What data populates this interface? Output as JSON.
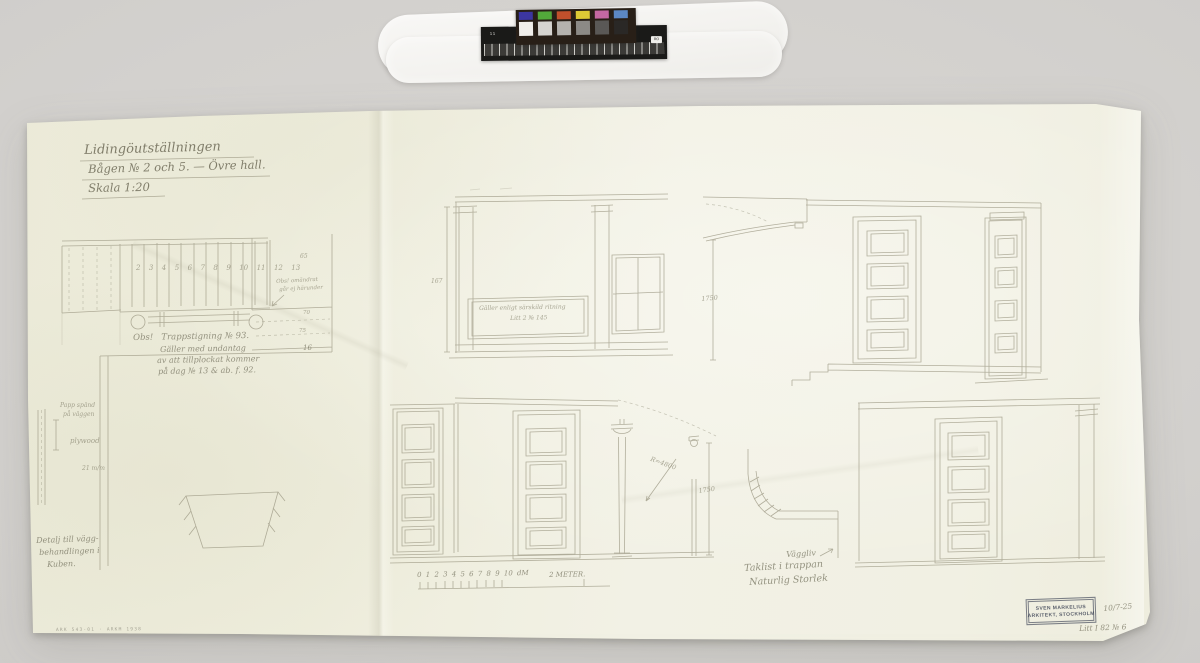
{
  "background": {
    "color": "#d5d3d0"
  },
  "calibration": {
    "ruler_left_label": "11",
    "ruler_right_label": "RO",
    "color_chips": [
      "#3c36a0",
      "#52a83a",
      "#c0502c",
      "#ddca35",
      "#c468a2",
      "#5c88c4"
    ],
    "gray_chips": [
      "#f0eeea",
      "#d6d4d0",
      "#b4b2ae",
      "#8c8a86",
      "#5a5856",
      "#2a2826"
    ]
  },
  "sheet": {
    "title": {
      "line1": "Lidingöutställningen",
      "line2": "Bågen № 2 och 5. — Övre hall.",
      "line3": "Skala 1:20"
    },
    "stair_note": {
      "line1": "Obs!   Trappstigning № 93.",
      "line2": "Gäller med undantag",
      "line3": "av att tillplockat kommer",
      "line4": "på dag № 13 & ab. f. 92."
    },
    "panel_note": {
      "line1": "Gäller enligt särskild ritning",
      "line2": "Litt 2 № 145"
    },
    "change_note": {
      "line1": "Obs! omändrat",
      "line2": "går ej härunder"
    },
    "wall_note": {
      "line1": "Papp spänd",
      "line2": "på väggen",
      "line3": "plywood",
      "line4": "21 m/m"
    },
    "detail_note": {
      "line1": "Detalj till vägg-",
      "line2": "behandlingen i",
      "line3": "Kuben."
    },
    "cove": {
      "label1": "Väggliv",
      "label2": "Taklist i trappan",
      "label3": "Naturlig Storlek"
    },
    "plan": {
      "steps": "2  3  4  5  6  7  8  9  10  11  12  13",
      "n65": "65",
      "n70": "70",
      "n75": "75",
      "n16": "16"
    },
    "dims": {
      "d167": "167",
      "d1750_top": "1750",
      "d1750_bottom": "1750",
      "radius": "R=4800"
    },
    "scale_bar": {
      "ticks": "0 1 2 3 4 5 6 7 8 9 10 dM",
      "meter": "2 METER."
    },
    "stamp": {
      "line1": "SVEN MARKELIUS",
      "line2": "ARKITEKT, STOCKHOLM"
    },
    "margin_notes": {
      "date": "10/7-25",
      "litt": "Litt I 82 № 6",
      "archive": "ARK 543-01 · ARKM 1938"
    }
  }
}
